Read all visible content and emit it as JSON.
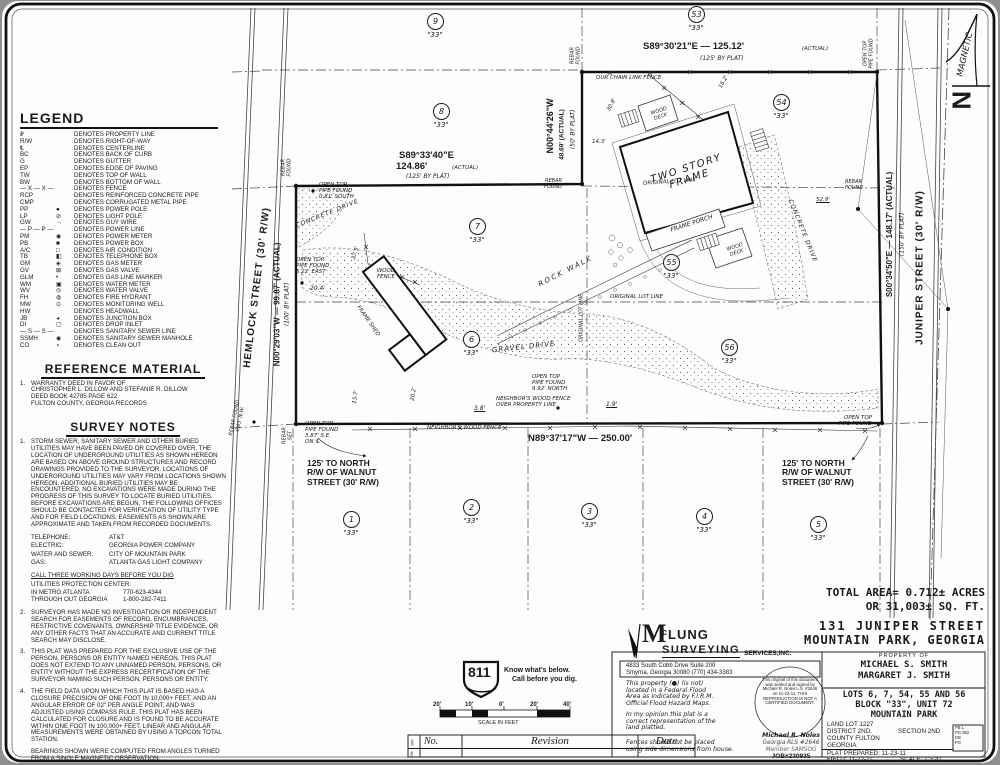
{
  "sheet": {
    "north": {
      "n": "N",
      "magnetic": "MAGNETIC"
    }
  },
  "legend": {
    "title": "LEGEND",
    "items": [
      {
        "a": "₽",
        "s": "",
        "d": "DENOTES PROPERTY LINE"
      },
      {
        "a": "R/W",
        "s": "",
        "d": "DENOTES RIGHT-OF-WAY"
      },
      {
        "a": "℄",
        "s": "",
        "d": "DENOTES CENTERLINE"
      },
      {
        "a": "BC",
        "s": "",
        "d": "DENOTES BACK OF CURB"
      },
      {
        "a": "G",
        "s": "",
        "d": "DENOTES GUTTER"
      },
      {
        "a": "EP",
        "s": "",
        "d": "DENOTES EDGE OF PAVING"
      },
      {
        "a": "TW",
        "s": "",
        "d": "DENOTES TOP OF WALL"
      },
      {
        "a": "BW",
        "s": "",
        "d": "DENOTES BOTTOM OF WALL"
      },
      {
        "a": "— X — X —",
        "s": "",
        "d": "DENOTES FENCE"
      },
      {
        "a": "RCP",
        "s": "",
        "d": "DENOTES REINFORCED CONCRETE PIPE"
      },
      {
        "a": "CMP",
        "s": "",
        "d": "DENOTES CORRUGATED METAL PIPE"
      },
      {
        "a": "PP",
        "s": "●",
        "d": "DENOTES POWER POLE"
      },
      {
        "a": "LP",
        "s": "⊘",
        "d": "DENOTES LIGHT POLE"
      },
      {
        "a": "GW",
        "s": "→",
        "d": "DENOTES GUY WIRE"
      },
      {
        "a": "— P — P —",
        "s": "",
        "d": "DENOTES POWER LINE"
      },
      {
        "a": "PM",
        "s": "◉",
        "d": "DENOTES POWER METER"
      },
      {
        "a": "PB",
        "s": "■",
        "d": "DENOTES POWER BOX"
      },
      {
        "a": "A/C",
        "s": "□",
        "d": "DENOTES AIR CONDITION"
      },
      {
        "a": "TB",
        "s": "◧",
        "d": "DENOTES TELEPHONE BOX"
      },
      {
        "a": "GM",
        "s": "◈",
        "d": "DENOTES GAS METER"
      },
      {
        "a": "GV",
        "s": "⊠",
        "d": "DENOTES GAS VALVE"
      },
      {
        "a": "GLM",
        "s": "•",
        "d": "DENOTES GAS LINE MARKER"
      },
      {
        "a": "WM",
        "s": "▣",
        "d": "DENOTES WATER METER"
      },
      {
        "a": "WV",
        "s": "◎",
        "d": "DENOTES WATER VALVE"
      },
      {
        "a": "FH",
        "s": "◍",
        "d": "DENOTES FIRE HYDRANT"
      },
      {
        "a": "MW",
        "s": "⊙",
        "d": "DENOTES MONITORING WELL"
      },
      {
        "a": "HW",
        "s": "",
        "d": "DENOTES HEADWALL"
      },
      {
        "a": "JB",
        "s": "◕",
        "d": "DENOTES JUNCTION BOX"
      },
      {
        "a": "DI",
        "s": "▢",
        "d": "DENOTES DROP INLET"
      },
      {
        "a": "— S — S —",
        "s": "",
        "d": "DENOTES SANITARY SEWER LINE"
      },
      {
        "a": "SSMH",
        "s": "◉",
        "d": "DENOTES SANITARY SEWER MANHOLE"
      },
      {
        "a": "CO",
        "s": "∘",
        "d": "DENOTES CLEAN OUT"
      }
    ]
  },
  "reference": {
    "title": "REFERENCE MATERIAL",
    "n": "1.",
    "text": "WARRANTY DEED IN FAVOR OF\nCHRISTOPHER L. DILLOW AND STEFANIE R. DILLOW\nDEED BOOK 42785 PAGE 622\nFULTON COUNTY, GEORGIA RECORDS"
  },
  "survey_notes": {
    "title": "SURVEY NOTES",
    "note1": {
      "n": "1.",
      "t": "STORM SEWER, SANITARY SEWER AND OTHER BURIED UTILITIES MAY HAVE BEEN PAVED OR COVERED OVER. THE LOCATION OF UNDERGROUND UTILITIES AS SHOWN HEREON ARE BASED ON ABOVE GROUND STRUCTURES AND RECORD DRAWINGS PROVIDED TO THE SURVEYOR. LOCATIONS OF UNDERGROUND UTILITIES MAY VARY FROM LOCATIONS SHOWN HEREON. ADDITIONAL BURIED UTILITIES MAY BE ENCOUNTERED. NO EXCAVATIONS WERE MADE DURING THE PROGRESS OF THIS SURVEY TO LOCATE BURIED UTILITIES. BEFORE EXCAVATIONS ARE BEGUN, THE FOLLOWING OFFICES SHOULD BE CONTACTED FOR VERIFICATION OF UTILITY TYPE AND FOR FIELD LOCATIONS. EASEMENTS AS SHOWN ARE APPROXIMATE AND TAKEN FROM RECORDED DOCUMENTS."
    },
    "utilities": [
      {
        "k": "TELEPHONE:",
        "v": "AT&T"
      },
      {
        "k": "ELECTRIC:",
        "v": "GEORGIA POWER COMPANY"
      },
      {
        "k": "WATER AND SEWER:",
        "v": "CITY OF MOUNTAIN PARK"
      },
      {
        "k": "GAS:",
        "v": "ATLANTA GAS LIGHT COMPANY"
      }
    ],
    "dig": {
      "title": "CALL THREE WORKING DAYS BEFORE YOU DIG",
      "sub": "UTILITIES PROTECTION CENTER:",
      "rows": [
        {
          "k": "IN METRO ATLANTA",
          "v": "770-623-4344"
        },
        {
          "k": "THROUGH OUT GEORGIA",
          "v": "1-800-282-7411"
        }
      ]
    },
    "notes": [
      {
        "n": "2.",
        "t": "SURVEYOR HAS MADE NO INVESTIGATION OR INDEPENDENT SEARCH FOR EASEMENTS OF RECORD, ENCUMBRANCES, RESTRICTIVE COVENANTS, OWNERSHIP TITLE EVIDENCE, OR ANY OTHER FACTS THAT AN ACCURATE AND CURRENT TITLE SEARCH MAY DISCLOSE."
      },
      {
        "n": "3.",
        "t": "THIS PLAT WAS PREPARED FOR THE EXCLUSIVE USE OF THE PERSON, PERSONS OR ENTITY NAMED HEREON. THIS PLAT DOES NOT EXTEND TO ANY UNNAMED PERSON, PERSONS, OR ENTITY WITHOUT THE EXPRESS RECERTIFICATION OF THE SURVEYOR NAMING SUCH PERSON, PERSONS OR ENTITY."
      },
      {
        "n": "4.",
        "t": "THE FIELD DATA UPON WHICH THIS PLAT IS BASED HAS A CLOSURE PRECISION OF ONE FOOT IN 10,000+ FEET, AND AN ANGULAR ERROR OF 02\" PER ANGLE POINT, AND WAS ADJUSTED USING COMPASS RULE. THIS PLAT HAS BEEN CALCULATED FOR CLOSURE AND IS FOUND TO BE ACCURATE WITHIN ONE FOOT IN 100,000+ FEET. LINEAR AND ANGULAR MEASUREMENTS WERE OBTAINED BY USING A TOPCON TOTAL STATION."
      },
      {
        "n": "",
        "t": "BEARINGS SHOWN WERE COMPUTED FROM ANGLES TURNED FROM A SINGLE MAGNETIC OBSERVATION."
      },
      {
        "n": "5.",
        "t": "THIS PLAT NOT INTENDED FOR RECORDING."
      }
    ]
  },
  "drawing": {
    "lots": [
      {
        "n": "9",
        "x": 427,
        "y": 13,
        "q": "\"33\""
      },
      {
        "n": "8",
        "x": 433,
        "y": 103,
        "q": "\"33\""
      },
      {
        "n": "53",
        "x": 688,
        "y": 6,
        "q": "\"33\""
      },
      {
        "n": "54",
        "x": 773,
        "y": 94,
        "q": "\"33\""
      },
      {
        "n": "7",
        "x": 469,
        "y": 218,
        "q": "\"33\""
      },
      {
        "n": "55",
        "x": 663,
        "y": 254,
        "q": "\"33\""
      },
      {
        "n": "56",
        "x": 721,
        "y": 339,
        "q": "\"33\""
      },
      {
        "n": "6",
        "x": 463,
        "y": 331,
        "q": "\"33\""
      },
      {
        "n": "1",
        "x": 343,
        "y": 511,
        "q": "\"33\""
      },
      {
        "n": "2",
        "x": 463,
        "y": 499,
        "q": "\"33\""
      },
      {
        "n": "3",
        "x": 581,
        "y": 503,
        "q": "\"33\""
      },
      {
        "n": "4",
        "x": 696,
        "y": 508,
        "q": "\"33\""
      },
      {
        "n": "5",
        "x": 810,
        "y": 516,
        "q": "\"33\""
      }
    ],
    "labels": [
      {
        "t": "S89°30'21\"E — 125.12'",
        "x": 643,
        "y": 42,
        "fs": 9.5,
        "cls": "b"
      },
      {
        "t": "(ACTUAL)",
        "x": 802,
        "y": 46,
        "fs": 5.5
      },
      {
        "t": "(125' BY PLAT)",
        "x": 700,
        "y": 56,
        "fs": 6
      },
      {
        "t": "S89°33'40\"E",
        "x": 399,
        "y": 151,
        "fs": 9.5,
        "cls": "b"
      },
      {
        "t": "124.86'",
        "x": 396,
        "y": 162,
        "fs": 9.5,
        "cls": "b"
      },
      {
        "t": "(ACTUAL)",
        "x": 452,
        "y": 165,
        "fs": 5.5
      },
      {
        "t": "(125' BY PLAT)",
        "x": 406,
        "y": 174,
        "fs": 6
      },
      {
        "t": "N00°44'26\"W",
        "x": 506,
        "y": 121,
        "w": 90,
        "ta": "center",
        "r": -90,
        "fs": 9,
        "cls": "b"
      },
      {
        "t": "48.69' (ACTUAL)",
        "x": 517,
        "y": 131,
        "w": 90,
        "ta": "center",
        "r": -90,
        "fs": 6.5,
        "cls": "b"
      },
      {
        "t": "(50' BY PLAT)",
        "x": 529,
        "y": 126,
        "w": 90,
        "ta": "center",
        "r": -90,
        "fs": 6
      },
      {
        "t": "N00°29'03\"W — 99.87' (ACTUAL)",
        "x": 203,
        "y": 300,
        "w": 150,
        "ta": "center",
        "r": -90,
        "fs": 8,
        "cls": "b"
      },
      {
        "t": "(100' BY PLAT)",
        "x": 243,
        "y": 301,
        "w": 90,
        "ta": "center",
        "r": -90,
        "fs": 6
      },
      {
        "t": "S00°34'50\"E — 148.17' (ACTUAL)",
        "x": 813,
        "y": 230,
        "w": 155,
        "ta": "center",
        "r": -90,
        "fs": 8,
        "cls": "b"
      },
      {
        "t": "(150' BY PLAT)",
        "x": 858,
        "y": 231,
        "w": 90,
        "ta": "center",
        "r": -90,
        "fs": 6
      },
      {
        "t": "N89°37'17\"W — 250.00'",
        "x": 528,
        "y": 434,
        "fs": 9.5,
        "cls": "b"
      },
      {
        "t": "JUNIPER STREET (30' R/W)",
        "x": 840,
        "y": 262,
        "w": 160,
        "ta": "center",
        "r": -90,
        "fs": 10,
        "cls": "b ls1"
      },
      {
        "t": "HEMLOCK STREET (30' R/W)",
        "x": 157,
        "y": 282,
        "w": 200,
        "ta": "center",
        "r": -83,
        "fs": 10,
        "cls": "b ls1"
      },
      {
        "t": "MAGNETIC",
        "x": 930,
        "y": 50,
        "w": 72,
        "ta": "center",
        "r": -77,
        "fs": 8.5
      },
      {
        "t": "REBAR\nFOUND",
        "x": 272,
        "y": 162,
        "w": 30,
        "ta": "center",
        "r": -90,
        "fs": 5
      },
      {
        "t": "REBAR\nFOUND",
        "x": 561,
        "y": 50,
        "w": 30,
        "ta": "center",
        "r": -90,
        "fs": 5
      },
      {
        "t": "OPEN TOP\nPIPE FOUND",
        "x": 848,
        "y": 48,
        "w": 42,
        "ta": "center",
        "r": -90,
        "fs": 5
      },
      {
        "t": "REBAR\nFOUND",
        "x": 532,
        "y": 179,
        "w": 30,
        "ta": "right",
        "fs": 5
      },
      {
        "t": "REBAR\nFOUND",
        "x": 845,
        "y": 180,
        "fs": 5
      },
      {
        "t": "OPEN TOP\nPIPE FOUND\n0.81' SOUTH",
        "x": 319,
        "y": 182,
        "fs": 5.5
      },
      {
        "t": "OPEN TOP\nPIPE FOUND\n5.22' EAST",
        "x": 296,
        "y": 257,
        "fs": 5.5
      },
      {
        "t": "20.4'",
        "x": 310,
        "y": 286,
        "fs": 6
      },
      {
        "t": "OPEN TOP\nPIPE FOUND\n9.92' NORTH",
        "x": 532,
        "y": 374,
        "fs": 5.5
      },
      {
        "t": "NEIGHBOR'S WOOD FENCE\nOVER PROPERTY LINE",
        "x": 496,
        "y": 396,
        "fs": 5.5
      },
      {
        "t": "3.8'",
        "x": 474,
        "y": 406,
        "fs": 6,
        "cls": "u"
      },
      {
        "t": "1.9'",
        "x": 606,
        "y": 402,
        "fs": 6,
        "cls": "u"
      },
      {
        "t": "NEIGHBOR'S WOOD FENCE",
        "x": 427,
        "y": 425,
        "fs": 5.5
      },
      {
        "t": "OPEN TOP\nPIPE FOUND\n3.87' S.E.\nON ℄",
        "x": 305,
        "y": 421,
        "fs": 5.5
      },
      {
        "t": "REBAR\nSET",
        "x": 275,
        "y": 430,
        "w": 26,
        "ta": "center",
        "r": -90,
        "fs": 5
      },
      {
        "t": "REBAR FOUND\n0.63' N.W.",
        "x": 216,
        "y": 413,
        "w": 44,
        "ta": "center",
        "r": -78,
        "fs": 5
      },
      {
        "t": "OPEN TOP\nPIPE FOUND",
        "x": 832,
        "y": 415,
        "w": 40,
        "ta": "right",
        "fs": 5.5
      },
      {
        "t": "OUR CHAIN LINK FENCE",
        "x": 596,
        "y": 75,
        "fs": 5.5
      },
      {
        "t": "ORIGINAL LOT LINE",
        "x": 643,
        "y": 179,
        "fs": 5.5,
        "r": -4
      },
      {
        "t": "ORIGINAL LOT LINE",
        "x": 610,
        "y": 294,
        "fs": 5.5
      },
      {
        "t": "ORIGINAL LOT LINE",
        "x": 553,
        "y": 315,
        "w": 58,
        "ta": "center",
        "r": -90,
        "fs": 5
      },
      {
        "t": "ROCK WALK",
        "x": 536,
        "y": 268,
        "fs": 7,
        "r": -27,
        "cls": "ls2"
      },
      {
        "t": "GRAVEL DRIVE",
        "x": 492,
        "y": 344,
        "fs": 7,
        "r": -6,
        "cls": "ls1"
      },
      {
        "t": "CONCRETE DRIVE",
        "x": 294,
        "y": 211,
        "fs": 6,
        "r": -22,
        "cls": "ls1"
      },
      {
        "t": "CONCRETE DRIVE",
        "x": 762,
        "y": 228,
        "w": 80,
        "ta": "center",
        "r": 68,
        "fs": 6,
        "cls": "ls1"
      },
      {
        "t": "WOOD\nDECK",
        "x": 644,
        "y": 109,
        "w": 32,
        "ta": "center",
        "r": -18,
        "fs": 5
      },
      {
        "t": "WOOD\nDECK",
        "x": 720,
        "y": 245,
        "w": 32,
        "ta": "center",
        "r": -18,
        "fs": 5
      },
      {
        "t": "WOOD\nFENCE",
        "x": 370,
        "y": 268,
        "w": 32,
        "ta": "center",
        "fs": 5.5
      },
      {
        "t": "TWO STORY FRAME",
        "x": 628,
        "y": 163,
        "w": 120,
        "ta": "center",
        "r": -18,
        "fs": 10,
        "cls": "sp"
      },
      {
        "t": "FRAME PORCH",
        "x": 660,
        "y": 221,
        "w": 64,
        "ta": "center",
        "r": -18,
        "fs": 6
      },
      {
        "t": "FRAME SHED",
        "x": 336,
        "y": 318,
        "w": 64,
        "ta": "center",
        "r": 55,
        "fs": 5.5
      },
      {
        "t": "14.3'",
        "x": 592,
        "y": 139,
        "fs": 5.5
      },
      {
        "t": "30.8'",
        "x": 605,
        "y": 102,
        "r": -62,
        "fs": 5.5
      },
      {
        "t": "16.2'",
        "x": 717,
        "y": 79,
        "r": -62,
        "fs": 5.5
      },
      {
        "t": "52.9'",
        "x": 816,
        "y": 197,
        "fs": 5.5,
        "cls": "u"
      },
      {
        "t": "37.5'",
        "x": 349,
        "y": 250,
        "r": -73,
        "fs": 5.5
      },
      {
        "t": "15.7'",
        "x": 349,
        "y": 394,
        "r": -80,
        "fs": 5.5
      },
      {
        "t": "20.2'",
        "x": 407,
        "y": 391,
        "r": -80,
        "fs": 5.5
      },
      {
        "t": "125' TO NORTH\nR/W OF WALNUT\nSTREET (30' R/W)",
        "x": 307,
        "y": 459,
        "fs": 8.5,
        "cls": "b"
      },
      {
        "t": "125' TO NORTH\nR/W OF WALNUT\nSTREET (30' R/W)",
        "x": 782,
        "y": 459,
        "fs": 8.5,
        "cls": "b"
      }
    ]
  },
  "call811": {
    "number": "811",
    "line1": "Know what's below.",
    "line2": "Call before you dig."
  },
  "scale_bar": {
    "labels": [
      {
        "t": "20'",
        "x": 433,
        "y": 702
      },
      {
        "t": "10'",
        "x": 465,
        "y": 702
      },
      {
        "t": "0'",
        "x": 499,
        "y": 702
      },
      {
        "t": "20'",
        "x": 530,
        "y": 702
      },
      {
        "t": "40'",
        "x": 563,
        "y": 702
      }
    ],
    "caption": "SCALE IN FEET"
  },
  "revision": {
    "no": "No.",
    "revision": "Revision",
    "date": "Date",
    "side1": "DR:",
    "side2": "DB:"
  },
  "title_block": {
    "total1": "TOTAL AREA= 0.712± ACRES",
    "total2": "OR 31,003± SQ. FT.",
    "addr1": "131 JUNIPER STREET",
    "addr2": "MOUNTAIN PARK, GEORGIA",
    "firm_m": "M",
    "firm_c": "c",
    "firm_lung": "LUNG",
    "firm_surveying": "SURVEYING",
    "firm_services": "SERVICES,INC.",
    "firm_addr1": "4833 South Cobb Drive Suite 200",
    "firm_addr2": "Smyrna, Georgia 30080 (770) 434-3383",
    "flood": "This property (●) (is not)\nlocated in a Federal Flood\nArea as indicated by F.I.R.M.\nOfficial Flood Hazard Maps.",
    "opinion": "In my opinion this plat is a\ncorrect representation of the\nland platted.",
    "fences": "Fences should not be placed\nusing side dimensions from house.",
    "stamp": "This original of this document was sealed and signed by Michael R. Noles L.S. #2646 on 11-23-11. THIS REPRODUCTION IS NOT A CERTIFIED DOCUMENT.",
    "signer1": "Michael R. Noles",
    "signer2": "Georgia RLS #2646",
    "signer3": "Member SAMSOG",
    "job": "JOB#230935",
    "prop_of": "PROPERTY OF",
    "owner1": "MICHAEL S. SMITH",
    "owner2": "MARGARET J. SMITH",
    "lots1": "LOTS 6, 7, 54, 55 AND 56",
    "lots2": "BLOCK \"33\", UNIT 72",
    "lots3": "MOUNTAIN PARK",
    "land_lot": "LAND LOT 1227",
    "district": "DISTRICT 2ND.",
    "section": "SECTION 2ND",
    "county": "COUNTY FULTON",
    "state": "GEORGIA",
    "prepared": "PLAT PREPARED: 11-23-11",
    "field": "FIELD: 11-22-11",
    "scale": "SCALE: 1\"=20'",
    "pb1": "PB L",
    "pb2": "PG 582",
    "pb3": "DB",
    "pb4": "PG"
  }
}
